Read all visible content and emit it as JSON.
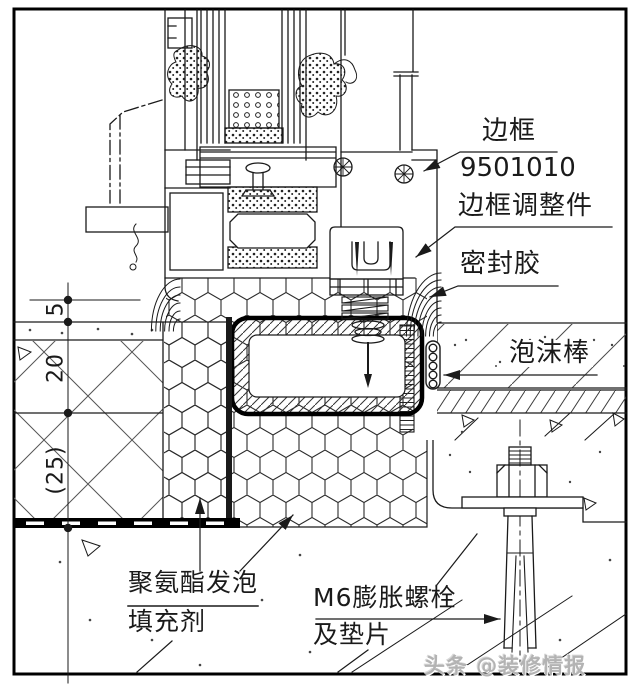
{
  "labels": {
    "frame": {
      "name": "边框",
      "code": "9501010"
    },
    "frame_adjuster": {
      "name": "边框调整件"
    },
    "sealant": {
      "name": "密封胶"
    },
    "foam_backer_rod": {
      "name": "泡沫棒"
    },
    "pu_foam": {
      "line1": "聚氨酯发泡",
      "line2": "填充剂"
    },
    "expansion_bolt": {
      "line1": "M6膨胀螺栓",
      "line2": "及垫片"
    }
  },
  "dimensions": {
    "joint_gap": "5",
    "finish_layer": "20",
    "sill_layer": "(25)"
  },
  "watermark": {
    "text": "头条 @装修情报"
  },
  "colors": {
    "line": "#1a1a1a",
    "paper": "#ffffff",
    "watermark_gray": "#b3b3b3"
  }
}
